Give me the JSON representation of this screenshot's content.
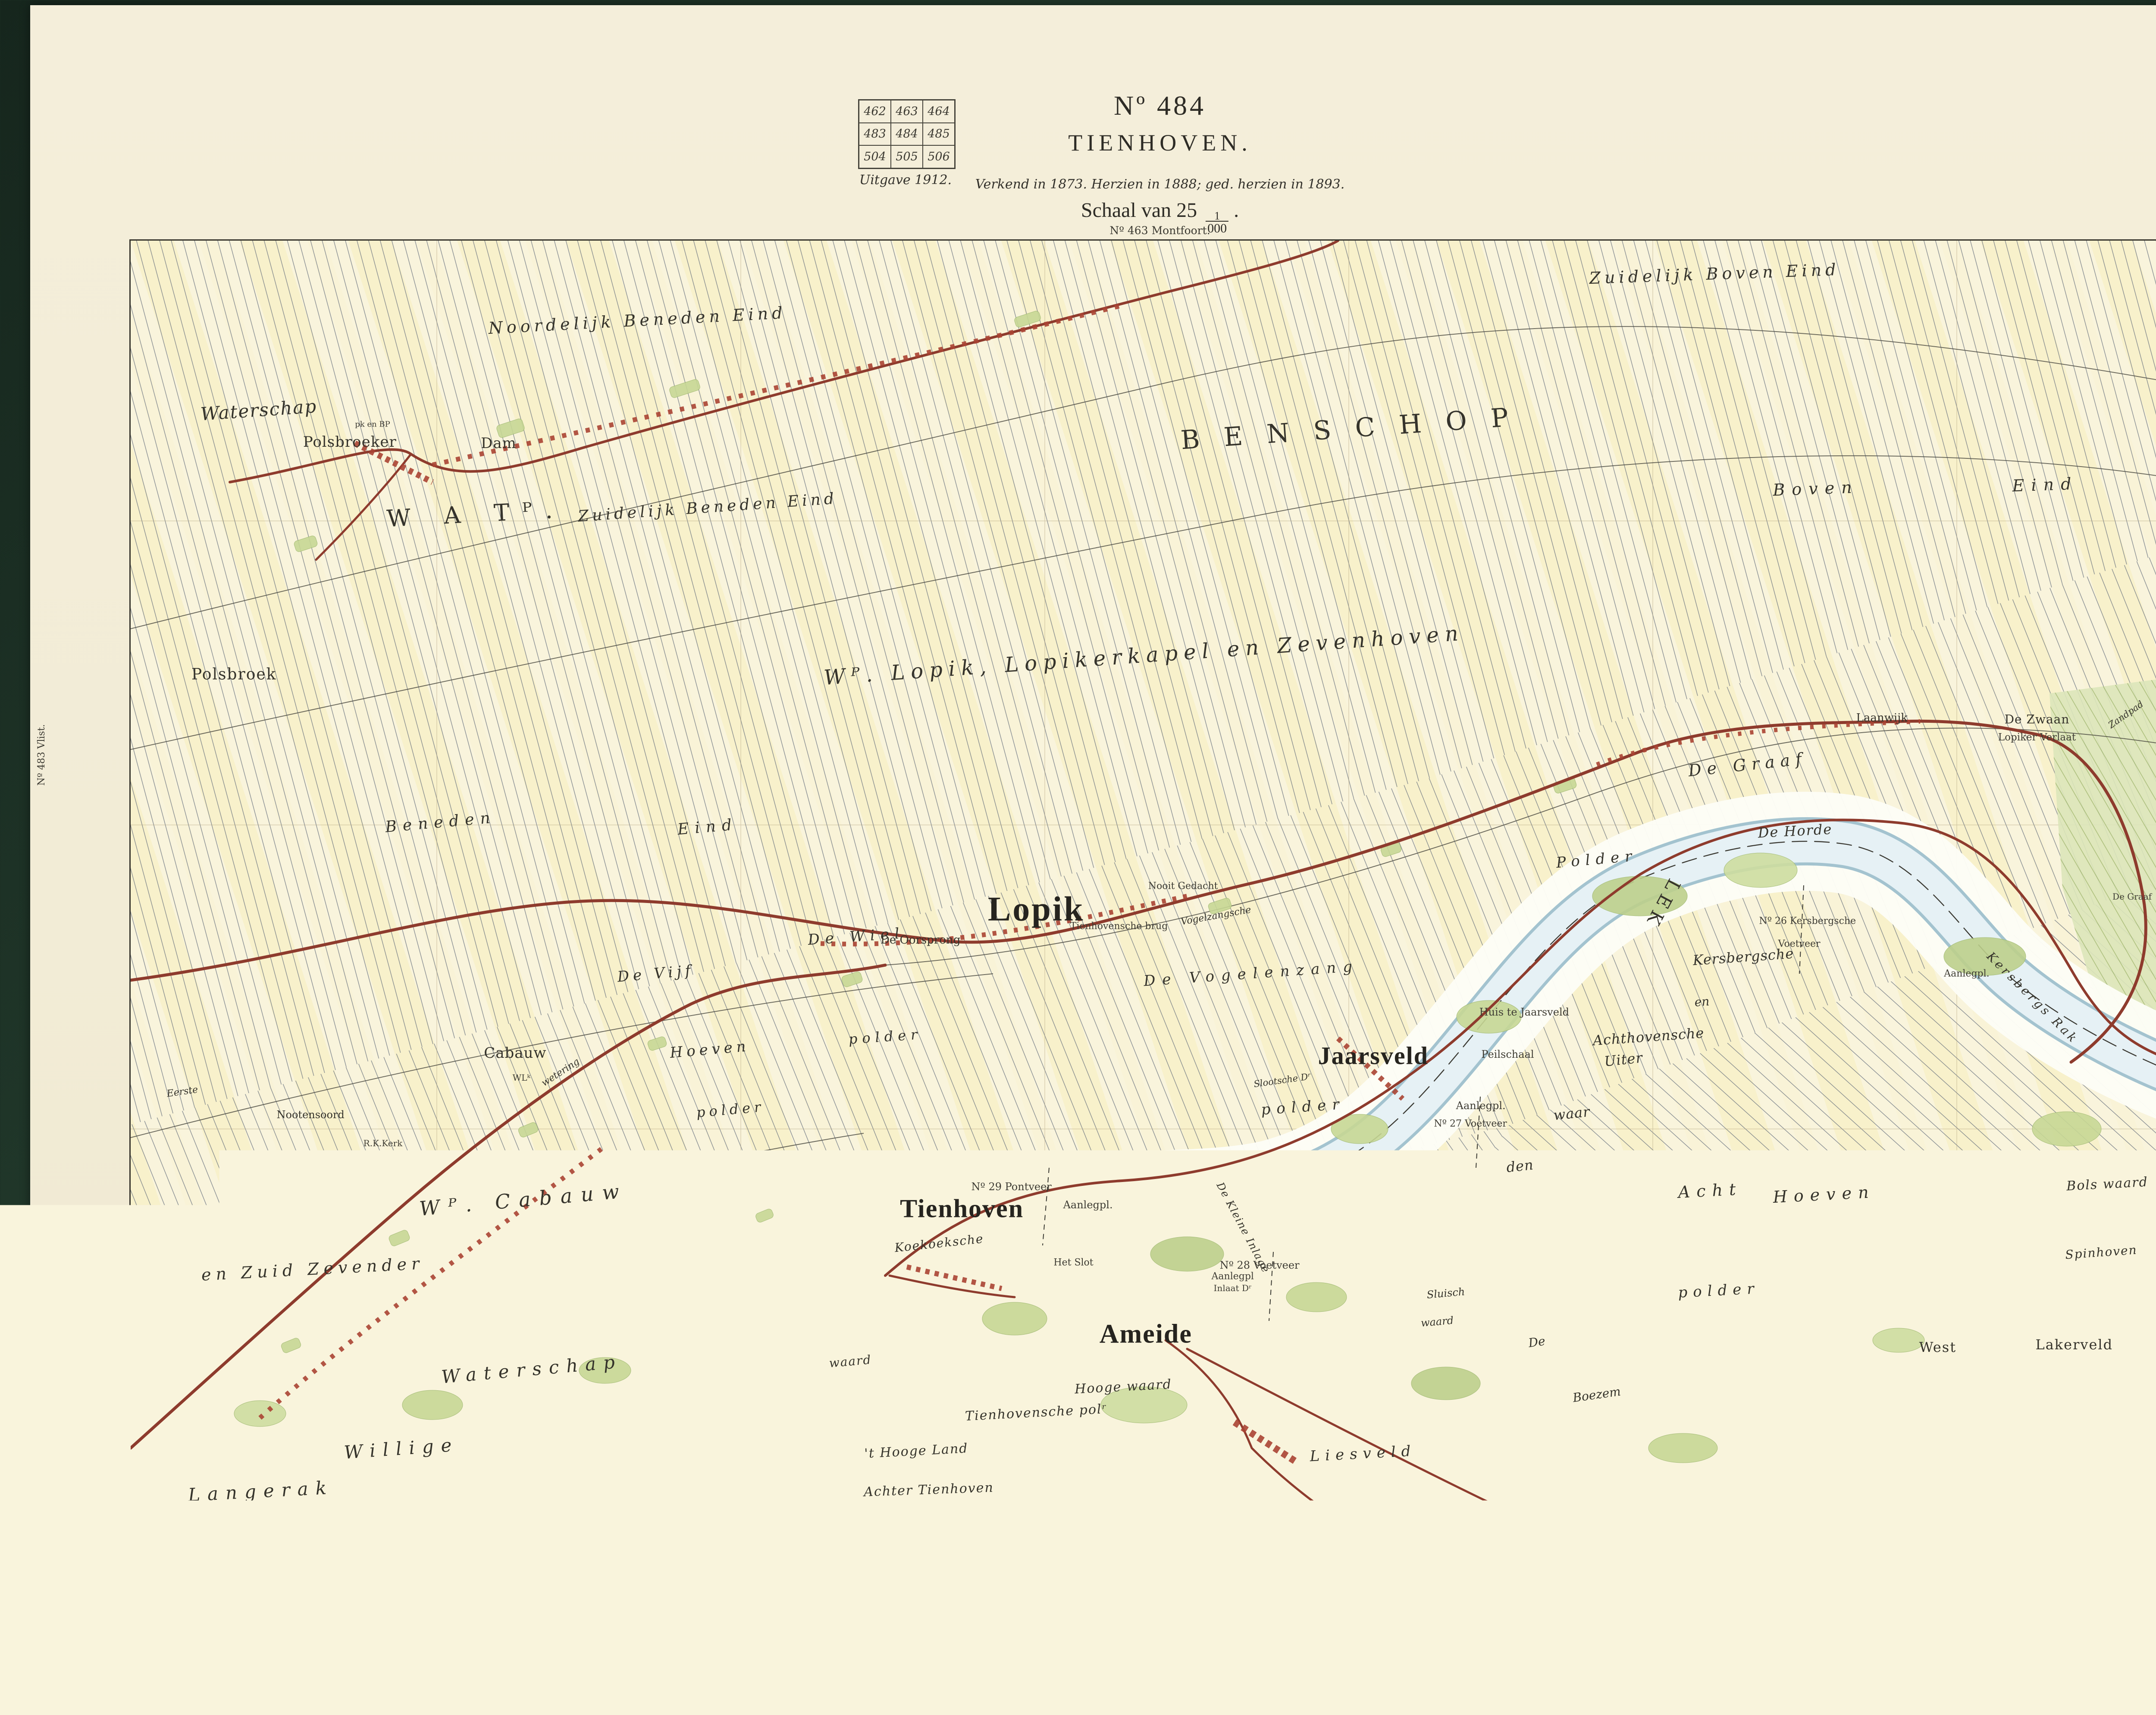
{
  "header": {
    "index_grid": {
      "rows": [
        [
          "462",
          "463",
          "464"
        ],
        [
          "483",
          "484",
          "485"
        ],
        [
          "504",
          "505",
          "506"
        ]
      ],
      "current_sheet": "484"
    },
    "edition": "Uitgave 1912.",
    "number": "Nº 484",
    "title": "TIENHOVEN.",
    "revision": "Verkend in 1873. Herzien in 1888; ged. herzien in 1893.",
    "scale_prefix": "Schaal van 25",
    "scale_frac_num": "1",
    "scale_frac_den": "000",
    "scale_suffix": "."
  },
  "map": {
    "adjacent_top": "Nº 463 Montfoort.",
    "adjacent_bottom": "Nº 505 Langerak.",
    "adjacent_left": "Nº 483 Vlist.",
    "adjacent_right": "Nº 485 Vianen.",
    "colors": {
      "paper": "#f2ecd6",
      "map_ground": "#f9f4dc",
      "water": "#dcecf2",
      "floodplain": "#fdfdf6",
      "road": "#8e3b2d",
      "greenery": "#c7d795",
      "parcel_line": "#67707d",
      "cover": "#1b2f24"
    },
    "labels": [
      {
        "t": "Noordelijk Beneden Eind",
        "x": 24.5,
        "y": 6.2,
        "s": 38,
        "ls": 9,
        "o": -3,
        "st": "it"
      },
      {
        "t": "Zuidelijk Boven Eind",
        "x": 76.6,
        "y": 2.6,
        "s": 38,
        "ls": 9,
        "o": -2,
        "st": "it"
      },
      {
        "t": "BENSCHOP",
        "x": 59.3,
        "y": 14.6,
        "s": 60,
        "ls": 56,
        "o": -4,
        "st": "rm"
      },
      {
        "t": "W A Tᴾ.",
        "x": 16.7,
        "y": 21.3,
        "s": 54,
        "ls": 30,
        "o": -3,
        "st": "rm"
      },
      {
        "t": "Waterschap",
        "x": 6.2,
        "y": 13.2,
        "s": 42,
        "ls": 2,
        "o": -4,
        "st": "it"
      },
      {
        "t": "pk en BP",
        "x": 11.7,
        "y": 14.3,
        "s": 18,
        "ls": 0,
        "o": 0,
        "st": "sm"
      },
      {
        "t": "Polsbroeker",
        "x": 10.6,
        "y": 15.7,
        "s": 34,
        "ls": 1,
        "o": 0,
        "st": "rm"
      },
      {
        "t": "Dam",
        "x": 17.8,
        "y": 15.8,
        "s": 34,
        "ls": 1,
        "o": 0,
        "st": "rm"
      },
      {
        "t": "Zuidelijk Beneden Eind",
        "x": 27.9,
        "y": 20.8,
        "s": 36,
        "ls": 8,
        "o": -4,
        "st": "it"
      },
      {
        "t": "Boven",
        "x": 81.5,
        "y": 19.3,
        "s": 38,
        "ls": 16,
        "o": -2,
        "st": "it"
      },
      {
        "t": "Eind",
        "x": 92.6,
        "y": 19.0,
        "s": 38,
        "ls": 16,
        "o": -2,
        "st": "it"
      },
      {
        "t": "Polsbroek",
        "x": 5.0,
        "y": 33.8,
        "s": 36,
        "ls": 2,
        "o": 0,
        "st": "rm"
      },
      {
        "t": "Wᴾ. Lopik, Lopikerkapel en Zevenhoven",
        "x": 49.0,
        "y": 32.3,
        "s": 48,
        "ls": 14,
        "o": -4,
        "st": "it"
      },
      {
        "t": "Beneden",
        "x": 15.0,
        "y": 45.3,
        "s": 36,
        "ls": 14,
        "o": -5,
        "st": "it"
      },
      {
        "t": "Eind",
        "x": 27.9,
        "y": 45.7,
        "s": 36,
        "ls": 14,
        "o": -5,
        "st": "it"
      },
      {
        "t": "Lopik",
        "x": 43.8,
        "y": 52.1,
        "s": 80,
        "ls": 4,
        "o": 0,
        "st": "big"
      },
      {
        "t": "De Zwaan",
        "x": 92.2,
        "y": 37.3,
        "s": 28,
        "ls": 1,
        "o": 0,
        "st": "rm"
      },
      {
        "t": "Laanwijk",
        "x": 84.7,
        "y": 37.2,
        "s": 26,
        "ls": 0,
        "o": 0,
        "st": "rm"
      },
      {
        "t": "Lopiker Verlaat",
        "x": 92.2,
        "y": 38.7,
        "s": 23,
        "ls": 0,
        "o": 0,
        "st": "sm"
      },
      {
        "t": "Zandpad",
        "x": 96.5,
        "y": 36.9,
        "s": 21,
        "ls": 0,
        "o": -35,
        "st": "it"
      },
      {
        "t": "De Graaf",
        "x": 78.2,
        "y": 40.8,
        "s": 38,
        "ls": 13,
        "o": -6,
        "st": "it"
      },
      {
        "t": "De Horde",
        "x": 80.5,
        "y": 46.0,
        "s": 32,
        "ls": 2,
        "o": -3,
        "st": "it"
      },
      {
        "t": "Polder",
        "x": 70.9,
        "y": 48.2,
        "s": 34,
        "ls": 13,
        "o": -5,
        "st": "it"
      },
      {
        "t": "LEK",
        "x": 74.1,
        "y": 51.7,
        "s": 42,
        "ls": 12,
        "o": 118,
        "st": "rm"
      },
      {
        "t": "Kersbergsche",
        "x": 78.0,
        "y": 55.8,
        "s": 32,
        "ls": 1,
        "o": -4,
        "st": "it"
      },
      {
        "t": "en",
        "x": 76.0,
        "y": 59.3,
        "s": 28,
        "ls": 0,
        "o": -4,
        "st": "it"
      },
      {
        "t": "Achthovensche",
        "x": 73.4,
        "y": 62.0,
        "s": 32,
        "ls": 1,
        "o": -4,
        "st": "it"
      },
      {
        "t": "Uiter",
        "x": 72.2,
        "y": 63.8,
        "s": 32,
        "ls": 1,
        "o": -6,
        "st": "it"
      },
      {
        "t": "waar",
        "x": 69.7,
        "y": 68.0,
        "s": 32,
        "ls": 1,
        "o": -6,
        "st": "it"
      },
      {
        "t": "den",
        "x": 67.2,
        "y": 72.1,
        "s": 32,
        "ls": 1,
        "o": -6,
        "st": "it"
      },
      {
        "t": "Nº 26 Kersbergsche",
        "x": 81.1,
        "y": 53.0,
        "s": 22,
        "ls": 0,
        "o": 0,
        "st": "sm"
      },
      {
        "t": "Voetveer",
        "x": 80.7,
        "y": 54.8,
        "s": 22,
        "ls": 0,
        "o": 0,
        "st": "sm"
      },
      {
        "t": "Aanlegpl.",
        "x": 88.8,
        "y": 57.1,
        "s": 22,
        "ls": 0,
        "o": 0,
        "st": "sm"
      },
      {
        "t": "Kersbergs Rak",
        "x": 92.0,
        "y": 59.0,
        "s": 28,
        "ls": 6,
        "o": 45,
        "st": "it"
      },
      {
        "t": "De Graaf",
        "x": 96.8,
        "y": 51.1,
        "s": 20,
        "ls": 0,
        "o": 0,
        "st": "sm"
      },
      {
        "t": "Jaarsveld",
        "x": 60.1,
        "y": 63.5,
        "s": 58,
        "ls": 2,
        "o": 0,
        "st": "big"
      },
      {
        "t": "Huis te Jaarsveld",
        "x": 67.4,
        "y": 60.1,
        "s": 24,
        "ls": 0,
        "o": 0,
        "st": "sm"
      },
      {
        "t": "Peilschaal",
        "x": 66.6,
        "y": 63.4,
        "s": 24,
        "ls": 0,
        "o": 0,
        "st": "sm"
      },
      {
        "t": "Aanlegpl.",
        "x": 65.3,
        "y": 67.4,
        "s": 24,
        "ls": 0,
        "o": 0,
        "st": "sm"
      },
      {
        "t": "Nº 27 Voetveer",
        "x": 64.8,
        "y": 68.8,
        "s": 22,
        "ls": 0,
        "o": 0,
        "st": "sm"
      },
      {
        "t": "Slootsche Dʳ",
        "x": 55.7,
        "y": 65.4,
        "s": 21,
        "ls": 0,
        "o": -8,
        "st": "it"
      },
      {
        "t": "polder",
        "x": 56.7,
        "y": 67.5,
        "s": 34,
        "ls": 14,
        "o": -4,
        "st": "it"
      },
      {
        "t": "De Vogelenzang",
        "x": 54.2,
        "y": 57.1,
        "s": 34,
        "ls": 16,
        "o": -4,
        "st": "it"
      },
      {
        "t": "De Wiel",
        "x": 35.1,
        "y": 54.2,
        "s": 34,
        "ls": 13,
        "o": -4,
        "st": "it"
      },
      {
        "t": "polder",
        "x": 36.5,
        "y": 62.0,
        "s": 32,
        "ls": 11,
        "o": -4,
        "st": "it"
      },
      {
        "t": "De Vijf",
        "x": 25.4,
        "y": 57.1,
        "s": 34,
        "ls": 9,
        "o": -5,
        "st": "it"
      },
      {
        "t": "Hoeven",
        "x": 28.0,
        "y": 63.0,
        "s": 34,
        "ls": 9,
        "o": -5,
        "st": "it"
      },
      {
        "t": "polder",
        "x": 29.0,
        "y": 67.7,
        "s": 32,
        "ls": 9,
        "o": -5,
        "st": "it"
      },
      {
        "t": "De Oorsprong",
        "x": 38.2,
        "y": 54.5,
        "s": 26,
        "ls": 0,
        "o": 0,
        "st": "rm"
      },
      {
        "t": "Nooit Gedacht",
        "x": 50.9,
        "y": 50.3,
        "s": 22,
        "ls": 0,
        "o": 0,
        "st": "sm"
      },
      {
        "t": "Tienhovensche brug",
        "x": 47.8,
        "y": 53.4,
        "s": 22,
        "ls": 0,
        "o": 0,
        "st": "sm"
      },
      {
        "t": "Vogelzangsche",
        "x": 52.5,
        "y": 52.6,
        "s": 22,
        "ls": 0,
        "o": -10,
        "st": "it"
      },
      {
        "t": "Wᴾ. Cabauw",
        "x": 19.0,
        "y": 74.7,
        "s": 46,
        "ls": 20,
        "o": -5,
        "st": "it"
      },
      {
        "t": "Cabauw",
        "x": 18.6,
        "y": 63.3,
        "s": 34,
        "ls": 1,
        "o": 0,
        "st": "rm"
      },
      {
        "t": "WLᵏ",
        "x": 18.9,
        "y": 65.2,
        "s": 20,
        "ls": 0,
        "o": 0,
        "st": "sm"
      },
      {
        "t": "Nootensoord",
        "x": 8.7,
        "y": 68.1,
        "s": 24,
        "ls": 0,
        "o": 0,
        "st": "rm"
      },
      {
        "t": "R.K.Kerk",
        "x": 12.2,
        "y": 70.3,
        "s": 20,
        "ls": 0,
        "o": 0,
        "st": "sm"
      },
      {
        "t": "Eerste",
        "x": 2.5,
        "y": 66.3,
        "s": 22,
        "ls": 0,
        "o": -8,
        "st": "it"
      },
      {
        "t": "wetering",
        "x": 20.8,
        "y": 64.8,
        "s": 22,
        "ls": 0,
        "o": -33,
        "st": "it"
      },
      {
        "t": "en Zuid Zevender",
        "x": 8.8,
        "y": 80.1,
        "s": 38,
        "ls": 11,
        "o": -3,
        "st": "it"
      },
      {
        "t": "Waterschap",
        "x": 19.4,
        "y": 87.9,
        "s": 42,
        "ls": 17,
        "o": -5,
        "st": "it"
      },
      {
        "t": "Willige",
        "x": 13.1,
        "y": 94.1,
        "s": 42,
        "ls": 17,
        "o": -4,
        "st": "it"
      },
      {
        "t": "Langerak",
        "x": 6.3,
        "y": 97.4,
        "s": 42,
        "ls": 17,
        "o": -3,
        "st": "it"
      },
      {
        "t": "Tienhoven",
        "x": 40.2,
        "y": 75.4,
        "s": 60,
        "ls": 2,
        "o": 0,
        "st": "big"
      },
      {
        "t": "Nº 29 Pontveer",
        "x": 42.6,
        "y": 73.7,
        "s": 24,
        "ls": 0,
        "o": 0,
        "st": "sm"
      },
      {
        "t": "Aanlegpl.",
        "x": 46.3,
        "y": 75.1,
        "s": 24,
        "ls": 0,
        "o": 0,
        "st": "sm"
      },
      {
        "t": "Koekoeksche",
        "x": 39.1,
        "y": 78.1,
        "s": 28,
        "ls": 2,
        "o": -6,
        "st": "it"
      },
      {
        "t": "waard",
        "x": 34.8,
        "y": 87.3,
        "s": 28,
        "ls": 2,
        "o": -5,
        "st": "it"
      },
      {
        "t": "Het Slot",
        "x": 45.6,
        "y": 79.6,
        "s": 22,
        "ls": 0,
        "o": 0,
        "st": "sm"
      },
      {
        "t": "Nº 28 Voetveer",
        "x": 54.6,
        "y": 79.8,
        "s": 24,
        "ls": 0,
        "o": 0,
        "st": "sm"
      },
      {
        "t": "Aanlegpl",
        "x": 53.3,
        "y": 80.7,
        "s": 22,
        "ls": 0,
        "o": 0,
        "st": "sm"
      },
      {
        "t": "Inlaat Dʳ",
        "x": 53.3,
        "y": 81.6,
        "s": 20,
        "ls": 0,
        "o": 0,
        "st": "sm"
      },
      {
        "t": "De Kleine Inlage",
        "x": 53.8,
        "y": 76.9,
        "s": 24,
        "ls": 2,
        "o": 62,
        "st": "it"
      },
      {
        "t": "Sluisch",
        "x": 63.6,
        "y": 82.0,
        "s": 24,
        "ls": 0,
        "o": -5,
        "st": "it"
      },
      {
        "t": "waard",
        "x": 63.2,
        "y": 84.2,
        "s": 24,
        "ls": 0,
        "o": -5,
        "st": "it"
      },
      {
        "t": "Ameide",
        "x": 49.1,
        "y": 85.2,
        "s": 62,
        "ls": 2,
        "o": 0,
        "st": "big"
      },
      {
        "t": "Hooge waard",
        "x": 48.0,
        "y": 89.3,
        "s": 30,
        "ls": 2,
        "o": -3,
        "st": "it"
      },
      {
        "t": "Tienhovensche polʳ",
        "x": 43.8,
        "y": 91.3,
        "s": 30,
        "ls": 2,
        "o": -3,
        "st": "it"
      },
      {
        "t": "'t Hooge Land",
        "x": 38.0,
        "y": 94.3,
        "s": 30,
        "ls": 2,
        "o": -3,
        "st": "it"
      },
      {
        "t": "Achter Tienhoven",
        "x": 38.6,
        "y": 97.3,
        "s": 30,
        "ls": 2,
        "o": -2,
        "st": "it"
      },
      {
        "t": "Liesveld",
        "x": 59.6,
        "y": 94.5,
        "s": 34,
        "ls": 13,
        "o": -3,
        "st": "it"
      },
      {
        "t": "De",
        "x": 68.0,
        "y": 85.8,
        "s": 28,
        "ls": 0,
        "o": -8,
        "st": "it"
      },
      {
        "t": "Boezem",
        "x": 70.9,
        "y": 89.9,
        "s": 28,
        "ls": 0,
        "o": -8,
        "st": "it"
      },
      {
        "t": "Acht",
        "x": 76.4,
        "y": 74.0,
        "s": 38,
        "ls": 15,
        "o": -3,
        "st": "it"
      },
      {
        "t": "Hoeven",
        "x": 81.9,
        "y": 74.3,
        "s": 38,
        "ls": 15,
        "o": -3,
        "st": "it"
      },
      {
        "t": "polder",
        "x": 76.8,
        "y": 81.8,
        "s": 34,
        "ls": 13,
        "o": -3,
        "st": "it"
      },
      {
        "t": "Bols waard",
        "x": 95.6,
        "y": 73.5,
        "s": 30,
        "ls": 2,
        "o": -3,
        "st": "it"
      },
      {
        "t": "Spinhoven",
        "x": 95.3,
        "y": 78.8,
        "s": 28,
        "ls": 2,
        "o": -4,
        "st": "it"
      },
      {
        "t": "West",
        "x": 87.4,
        "y": 86.2,
        "s": 32,
        "ls": 2,
        "o": 0,
        "st": "rm"
      },
      {
        "t": "Lakerveld",
        "x": 94.0,
        "y": 86.0,
        "s": 32,
        "ls": 2,
        "o": 0,
        "st": "rm"
      },
      {
        "t": "polder",
        "x": 90.4,
        "y": 96.7,
        "s": 32,
        "ls": 11,
        "o": -2,
        "st": "it"
      }
    ]
  },
  "scalebar": {
    "title": "Schaal van 5000 Meter.",
    "ticks": [
      "2500",
      "2250",
      "2000",
      "1750",
      "1500",
      "1250",
      "1000",
      "750",
      "500",
      "250",
      "0"
    ],
    "right_label": "2500 Meter."
  },
  "footer": {
    "imprint": "Topographische Inrichting.",
    "copyright": "De Auteursrechten zijn voorbehouden ten behoeve van den Staat der Nederlanden.",
    "nadruk": "Nadruk verboden."
  }
}
